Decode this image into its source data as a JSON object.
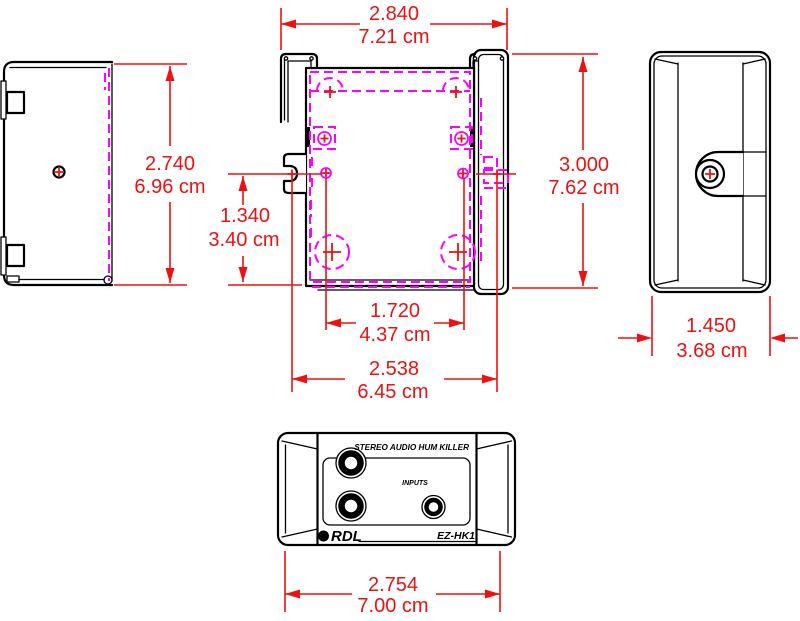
{
  "drawing": {
    "product_label": "STEREO AUDIO HUM KILLER",
    "inputs_label": "INPUTS",
    "brand": "RDL",
    "model": "EZ-HK1"
  },
  "dimensions": {
    "left_height": {
      "inches": "2.740",
      "cm": "6.96 cm"
    },
    "top_width": {
      "inches": "2.840",
      "cm": "7.21 cm"
    },
    "right_height": {
      "inches": "3.000",
      "cm": "7.62 cm"
    },
    "slot_offset": {
      "inches": "1.340",
      "cm": "3.40 cm"
    },
    "hole_spacing": {
      "inches": "1.720",
      "cm": "4.37 cm"
    },
    "plate_width": {
      "inches": "2.538",
      "cm": "6.45 cm"
    },
    "side_depth": {
      "inches": "1.450",
      "cm": "3.68 cm"
    },
    "front_width": {
      "inches": "2.754",
      "cm": "7.00 cm"
    }
  },
  "colors": {
    "dimension_red": "#ee1111",
    "hidden_magenta": "#ff00ff",
    "outline_black": "#000000",
    "background": "#ffffff"
  }
}
